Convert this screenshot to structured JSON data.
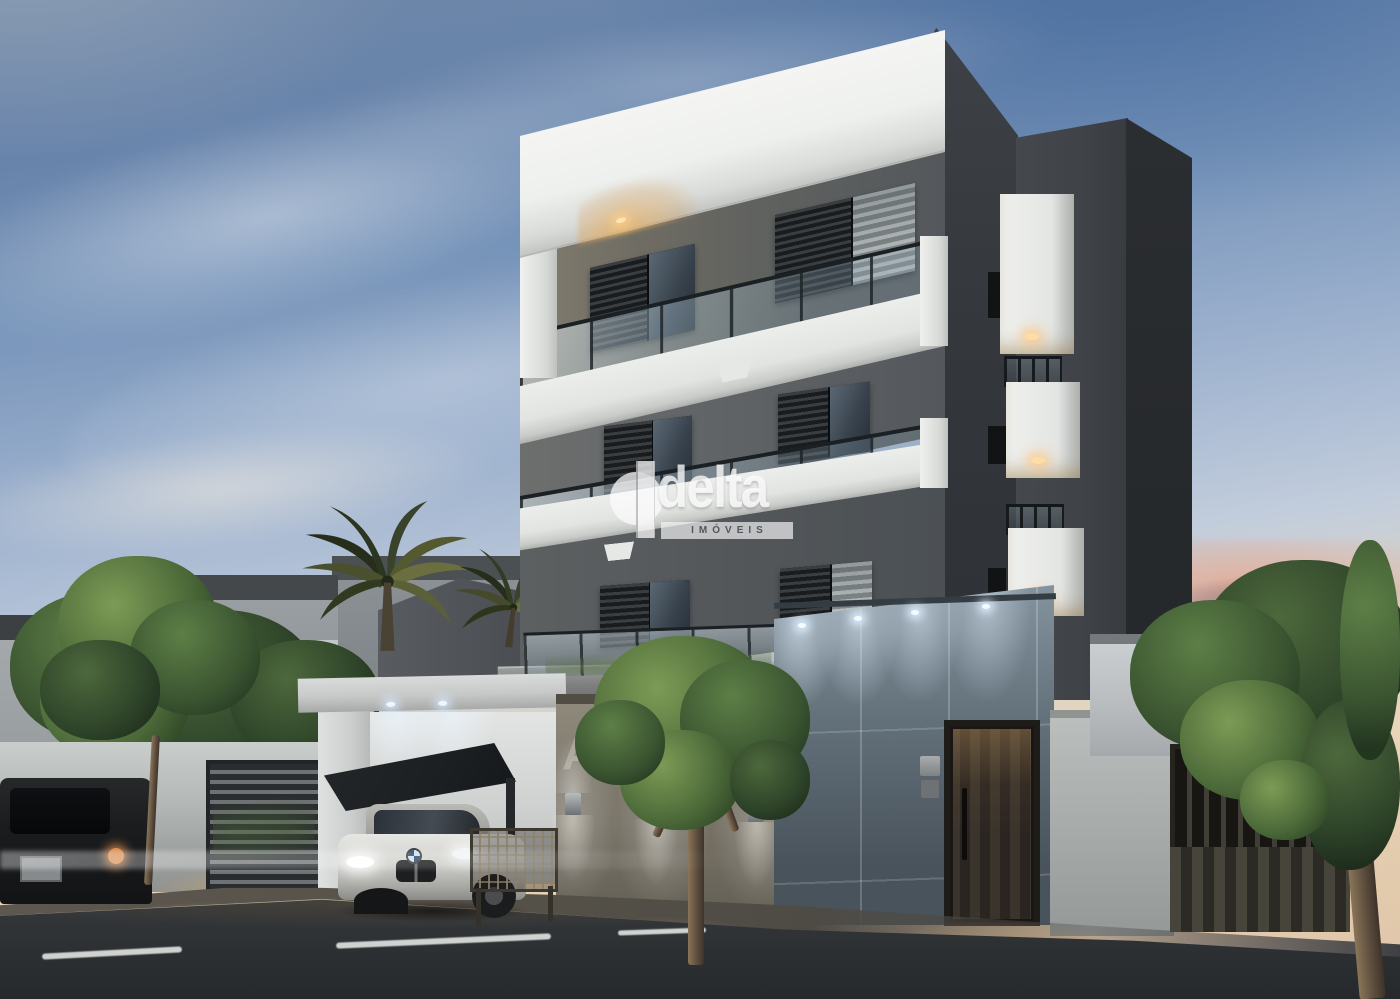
{
  "meta": {
    "type": "architectural-rendering",
    "scene": "modern-apartment-building-at-dusk"
  },
  "watermark": {
    "brand": "delta",
    "subtitle": "IMÓVEIS"
  },
  "building_sign": {
    "text": "AL"
  },
  "scene": {
    "subject": "three-story modern apartment building with balconies",
    "time_of_day": "dusk",
    "elements": [
      "white roof slab with warm spotlight",
      "glass balcony railings",
      "dark framed windows with shutters",
      "side balcony boxes with warm downlights",
      "street-level tiled wall with cool downlights",
      "wooden entrance door",
      "intercom panel",
      "carport with dark canopy",
      "white sedan parked in carport",
      "dark suv parked at curb",
      "louvered garage gate",
      "vertical-slat side gate",
      "mesh fence panel",
      "perimeter walls",
      "palm trees",
      "street trees",
      "background houses",
      "pink dusk clouds",
      "asphalt street with dashed lane marking",
      "sidewalk with warm pools of light"
    ]
  },
  "palette": {
    "sky_top": "#6e87a8",
    "sky_mid": "#9fb3cf",
    "sky_horizon": "#e9d4b8",
    "cloud_pink": "#e7a68e",
    "slab_white": "#eef0ee",
    "wall_gray": "#54585c",
    "band_white": "#e2e4e2",
    "tower_side": "#26292c",
    "tile_wall_top": "#84939e",
    "tile_wall_bottom": "#49535b",
    "foliage": "#3b5531",
    "foliage_lit": "#7d9b55",
    "street": "#2e3134",
    "warm_light": "#e8b271",
    "cool_light": "#dceafc",
    "watermark_white": "rgba(252,252,252,0.88)"
  },
  "vehicles": {
    "sedan_color": "white",
    "suv_color": "dark gray"
  }
}
